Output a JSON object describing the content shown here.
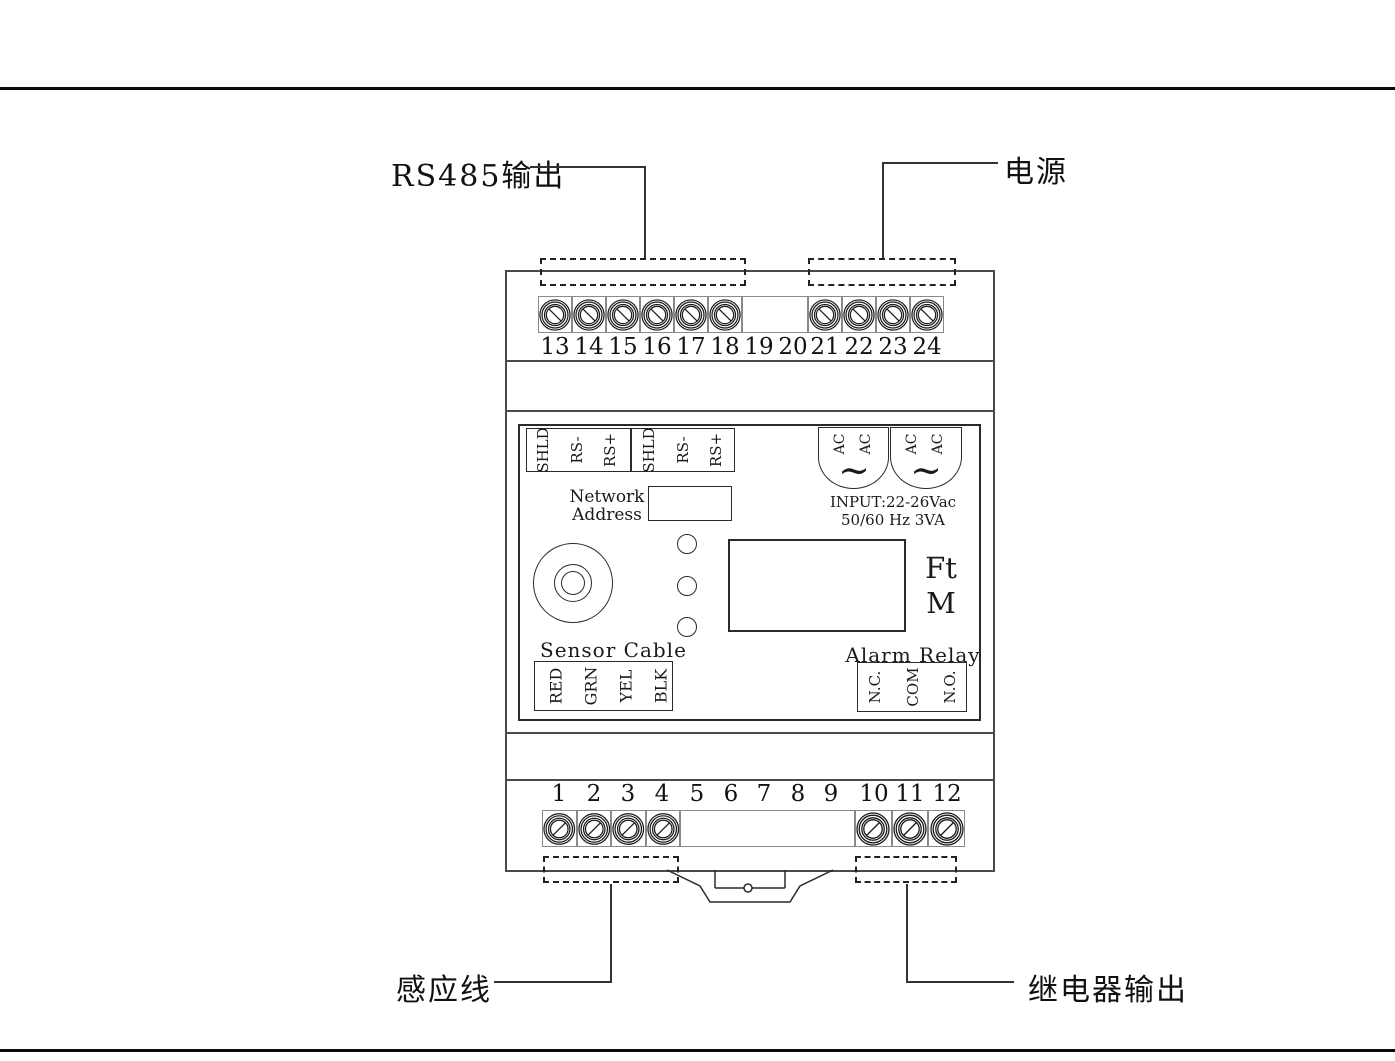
{
  "diagram": {
    "callouts": {
      "rs485_output": "RS485输出",
      "power": "电源",
      "sensor_wire": "感应线",
      "relay_output": "继电器输出"
    },
    "top_terminals": {
      "numbers": [
        "13",
        "14",
        "15",
        "16",
        "17",
        "18",
        "19",
        "20",
        "21",
        "22",
        "23",
        "24"
      ],
      "has_screw": [
        true,
        true,
        true,
        true,
        true,
        true,
        false,
        false,
        true,
        true,
        true,
        true
      ]
    },
    "bottom_terminals": {
      "numbers": [
        "1",
        "2",
        "3",
        "4",
        "5",
        "6",
        "7",
        "8",
        "9",
        "10",
        "11",
        "12"
      ],
      "has_screw": [
        true,
        true,
        true,
        true,
        false,
        false,
        false,
        false,
        false,
        true,
        true,
        true
      ]
    },
    "front_panel": {
      "comm_block": {
        "groups": [
          [
            "SHLD",
            "RS-",
            "RS+"
          ],
          [
            "SHLD",
            "RS-",
            "RS+"
          ]
        ]
      },
      "network_address_line1": "Network",
      "network_address_line2": "Address",
      "ac_block": {
        "terminal_label": "AC",
        "wave_symbol": "~",
        "input_line1": "INPUT:22-26Vac",
        "input_line2": "50/60 Hz 3VA"
      },
      "units": {
        "ft": "Ft",
        "m": "M"
      },
      "sensor_cable": {
        "title": "Sensor Cable",
        "wires": [
          "RED",
          "GRN",
          "YEL",
          "BLK"
        ]
      },
      "alarm_relay": {
        "title": "Alarm Relay",
        "contacts": [
          "N.C.",
          "COM",
          "N.O."
        ]
      }
    },
    "colors": {
      "ink": "#1a1a1a",
      "structure": "#4a4a4a",
      "cell_border": "#8a8a8a"
    }
  }
}
